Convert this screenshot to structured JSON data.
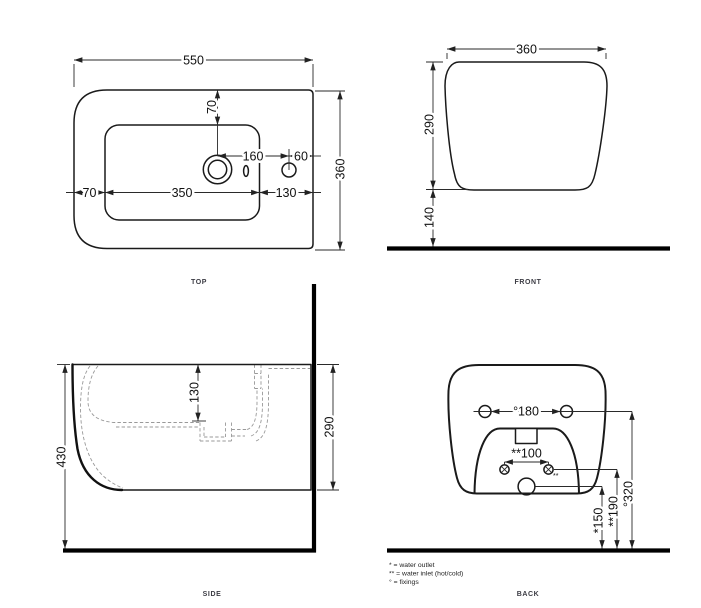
{
  "colors": {
    "ink": "#1a1a1a",
    "hidden_line": "#999999",
    "dim_line": "#2a2a2a",
    "floor": "#000000"
  },
  "views": {
    "top": {
      "label": "TOP",
      "dims": {
        "overall_width": "550",
        "overall_depth": "360",
        "rim_offset": "70",
        "left_offset": "70",
        "basin_length": "350",
        "right_offset": "130",
        "tap_to_hole": "160",
        "hole_to_edge": "60"
      }
    },
    "front": {
      "label": "FRONT",
      "dims": {
        "overall_width": "360",
        "body_height": "290",
        "floor_clearance": "140"
      }
    },
    "side": {
      "label": "SIDE",
      "dims": {
        "overall_height": "430",
        "basin_depth": "130",
        "body_height": "290"
      }
    },
    "back": {
      "label": "BACK",
      "dims": {
        "fixings_spacing": "°180",
        "inlet_spacing": "**100",
        "fixings_height": "°320",
        "inlet_height": "**190",
        "outlet_height": "*150",
        "inlet_note": "**"
      }
    }
  },
  "legend": {
    "water_outlet": "* = water outlet",
    "water_inlet": "** = water inlet (hot/cold)",
    "fixings": "° = fixings"
  }
}
